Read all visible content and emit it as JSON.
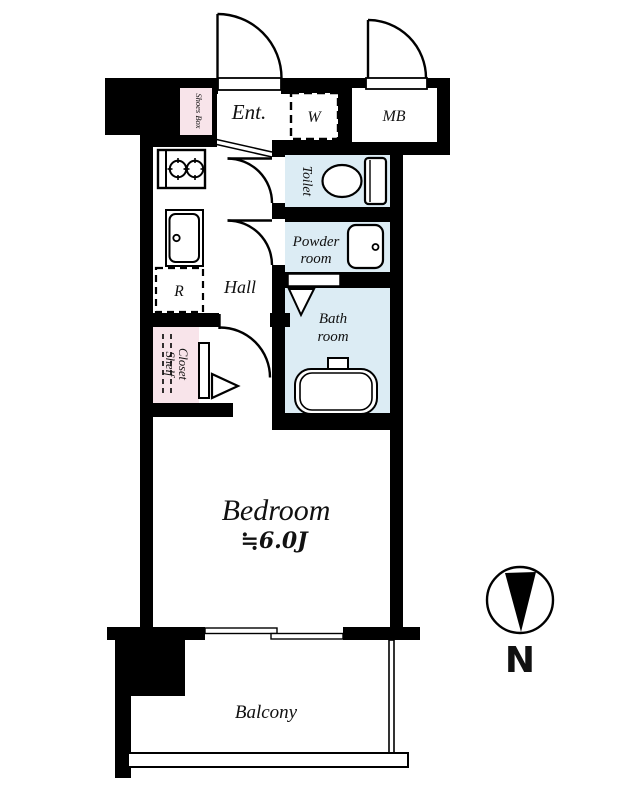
{
  "plan": {
    "rooms": {
      "entrance": "Ent.",
      "washer": "W",
      "meter_box": "MB",
      "shoes_box": "Shoes Box",
      "toilet": "Toilet",
      "powder_line1": "Powder",
      "powder_line2": "room",
      "bath_line1": "Bath",
      "bath_line2": "room",
      "hall": "Hall",
      "refrigerator": "R",
      "closet_line1": "Closet",
      "closet_line2": "Shelf",
      "bedroom": "Bedroom",
      "bedroom_size": "≒6.0J",
      "balcony": "Balcony"
    },
    "compass": {
      "north_label": "N"
    },
    "colors": {
      "wall": "#000000",
      "wet_area": "#dcecf4",
      "storage": "#f8e4ea"
    }
  }
}
